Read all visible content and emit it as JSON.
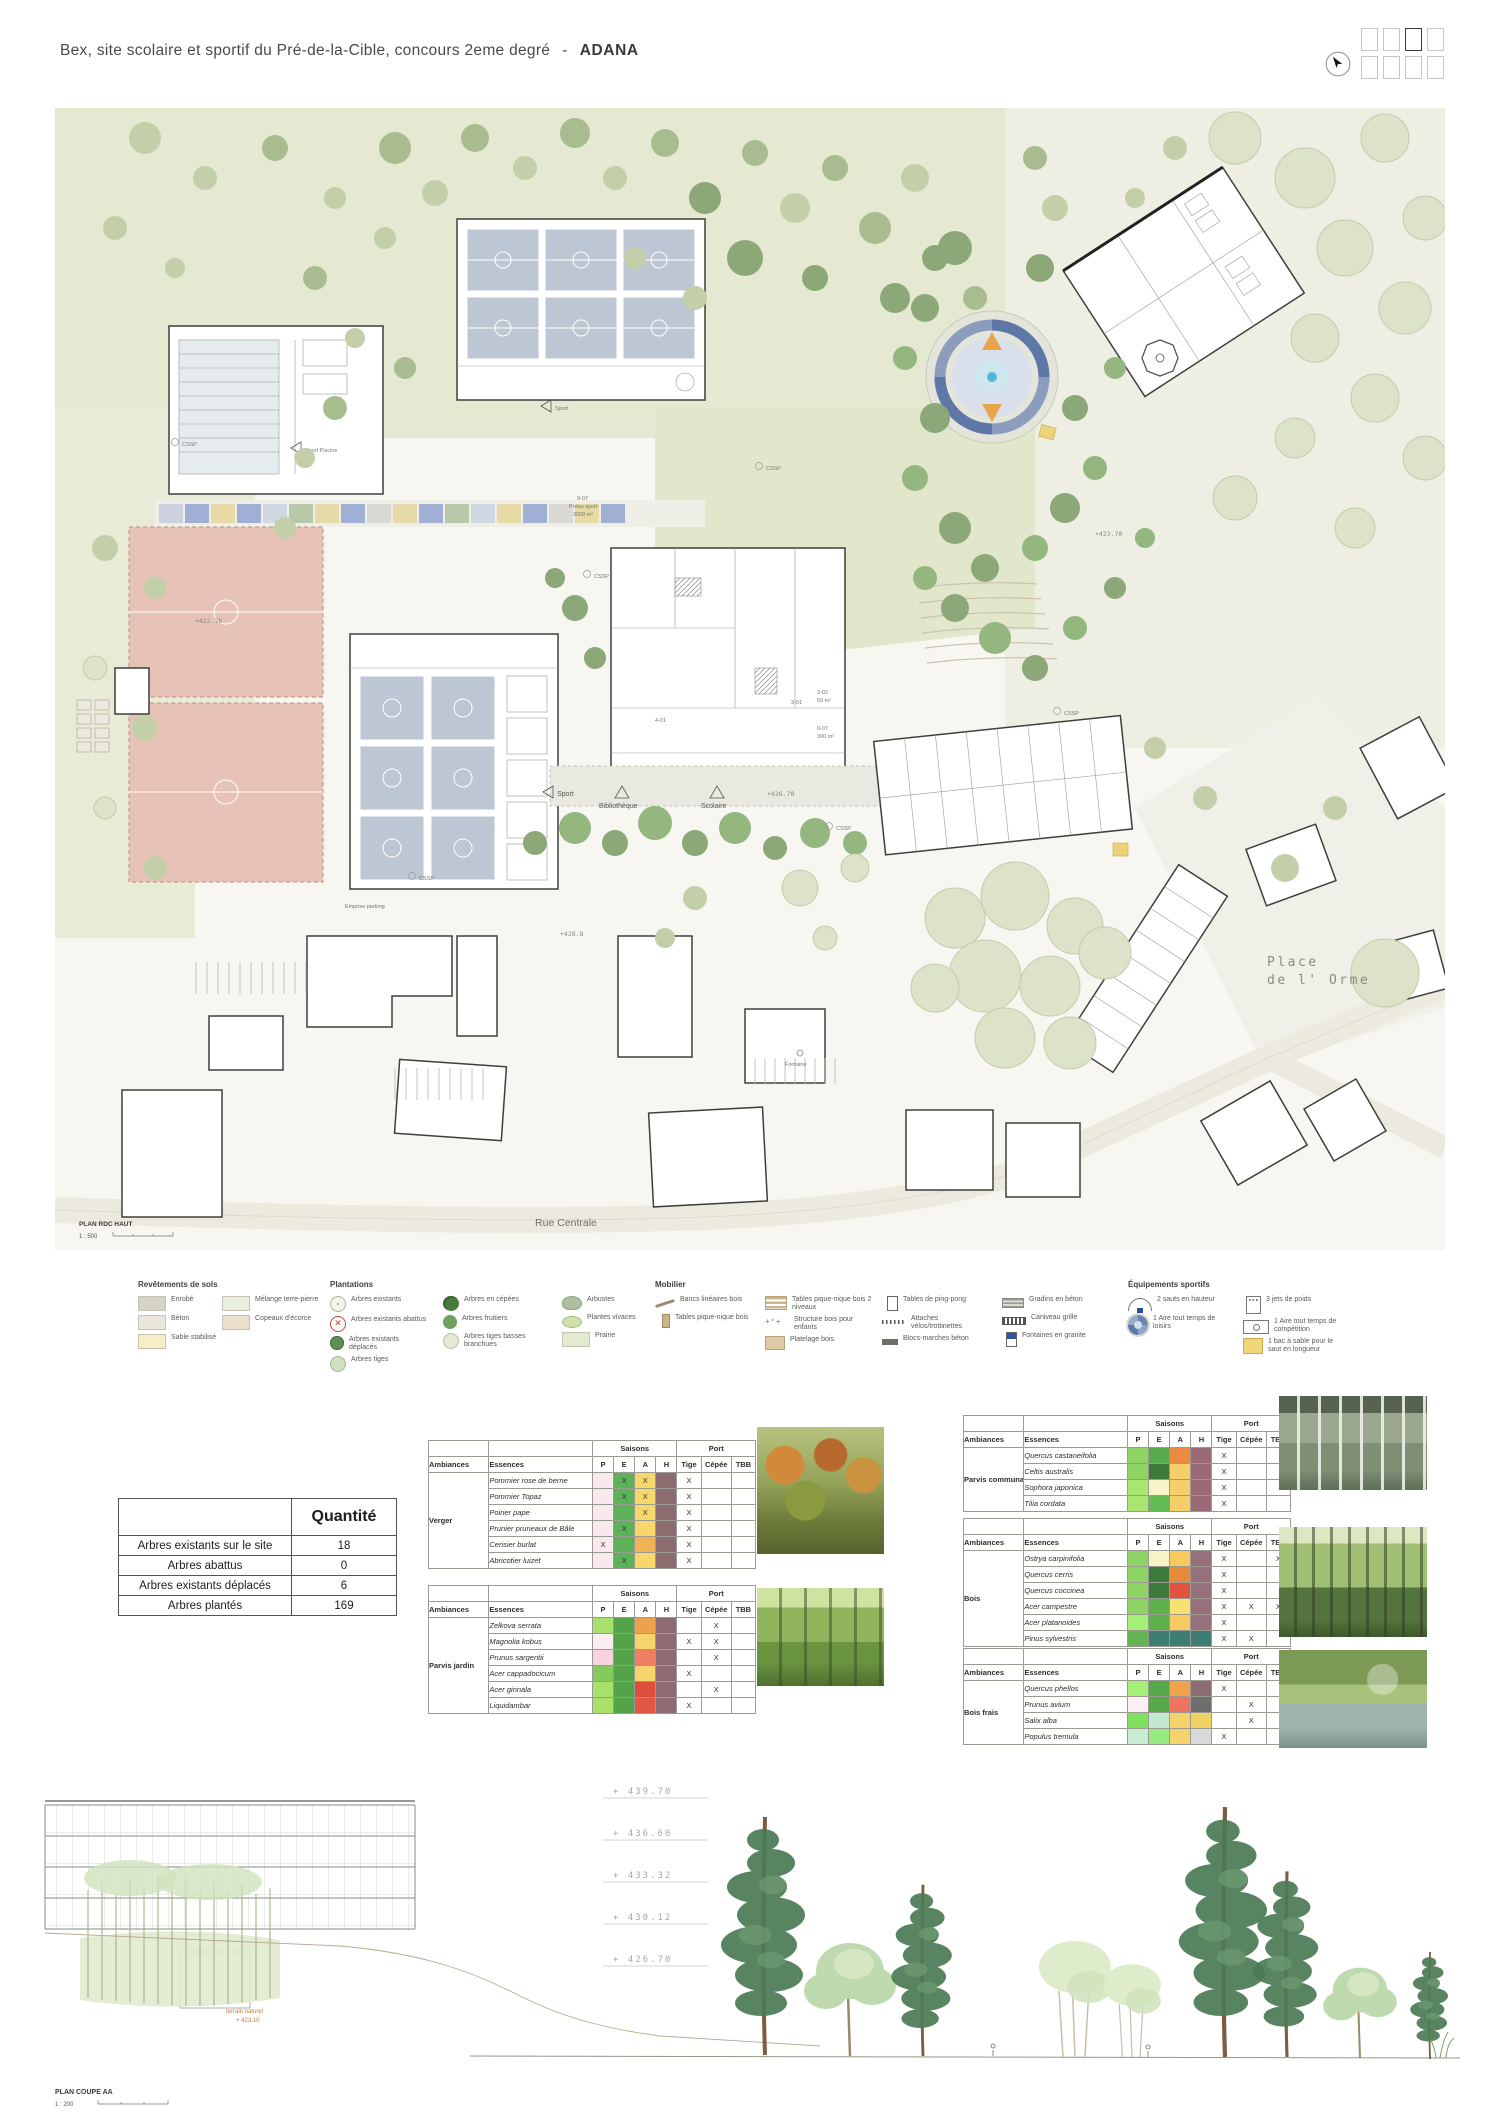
{
  "header": {
    "title": "Bex, site scolaire et sportif du Pré-de-la-Cible, concours 2eme degré",
    "separator": "-",
    "team": "ADANA"
  },
  "pager": {
    "count": 8,
    "active_index": 2
  },
  "plan": {
    "caption": {
      "title": "PLAN RDC HAUT",
      "scale": "1 : 500"
    },
    "labels": {
      "rue_centrale": "Rue Centrale",
      "place_line1": "Place",
      "place_line2": "de l' Orme",
      "sport": "Sport",
      "sport_piscine": "Sport Piscine",
      "bibliotheque": "Bibliothèque",
      "scolaire": "Scolaire",
      "preau_code": "9-07",
      "preau_name": "Préau sport",
      "preau_area": "3000 m²",
      "room1_code": "2-02",
      "room1_area": "50 m²",
      "room2_code": "0-07",
      "room2_area": "300 m²",
      "room3_code": "4-01",
      "room4_code": "3-01",
      "level_42370": "+423.70",
      "level_42276": "+422.76",
      "level_42670": "+426.70",
      "level_4288": "+428.8",
      "emprise_parking": "Emprise parking",
      "fontaine": "Fontaine",
      "cssp": "CSSP"
    }
  },
  "legend": {
    "columns": [
      {
        "header": "Revêtements de sols",
        "items": [
          {
            "icon": "swatch",
            "color": "#d8d3c7",
            "label": "Enrobé"
          },
          {
            "icon": "swatch",
            "color": "#ece5da",
            "label": "Béton"
          },
          {
            "icon": "swatch",
            "color": "#f6eec5",
            "label": "Sable stabilisé"
          }
        ]
      },
      {
        "header": "",
        "items": [
          {
            "icon": "swatch",
            "color": "#e9efdf",
            "label": "Mélange terre-pierre"
          },
          {
            "icon": "swatch",
            "color": "#eadfcb",
            "label": "Copeaux d'écorce"
          }
        ]
      },
      {
        "header": "Plantations",
        "items": [
          {
            "icon": "tree-existant",
            "label": "Arbres existants"
          },
          {
            "icon": "tree-abattu",
            "label": "Arbres existants abattus"
          },
          {
            "icon": "tree-deplace",
            "label": "Arbres existants déplacés"
          },
          {
            "icon": "tree-tige",
            "label": "Arbres tiges"
          }
        ]
      },
      {
        "header": "",
        "items": [
          {
            "icon": "tree-cepee",
            "label": "Arbres en cépées"
          },
          {
            "icon": "tree-fruitier",
            "label": "Arbres fruitiers"
          },
          {
            "icon": "tree-tbb",
            "label": "Arbres tiges basses branchues"
          }
        ]
      },
      {
        "header": "",
        "items": [
          {
            "icon": "arbuste",
            "label": "Arbustes"
          },
          {
            "icon": "vivace",
            "label": "Plantes vivaces"
          },
          {
            "icon": "swatch",
            "color": "#e2ead0",
            "label": "Prairie"
          }
        ]
      },
      {
        "header": "Mobilier",
        "items": [
          {
            "icon": "banc",
            "label": "Bancs linéaires bois"
          },
          {
            "icon": "table-pn",
            "label": "Tables pique-nique bois"
          }
        ]
      },
      {
        "header": "",
        "items": [
          {
            "icon": "table-pn2",
            "label": "Tables pique-nique bois 2 niveaux"
          },
          {
            "icon": "structure",
            "label": "Structure bois pour enfants"
          },
          {
            "icon": "platelage",
            "label": "Platelage bois"
          }
        ]
      },
      {
        "header": "",
        "items": [
          {
            "icon": "pingpong",
            "label": "Tables de ping-pong"
          },
          {
            "icon": "velos",
            "label": "Attaches vélos/trottinettes"
          },
          {
            "icon": "blocs",
            "label": "Blocs-marches béton"
          }
        ]
      },
      {
        "header": "",
        "items": [
          {
            "icon": "gradins",
            "label": "Gradins en béton"
          },
          {
            "icon": "caniveau",
            "label": "Caniveau grille"
          },
          {
            "icon": "fontaine",
            "label": "Fontaines en granite"
          }
        ]
      },
      {
        "header": "Équipements sportifs",
        "items": [
          {
            "icon": "saut-hauteur",
            "label": "2 sauts en hauteur"
          },
          {
            "icon": "aire-ronde",
            "label": "1 Aire tout temps de loisirs"
          }
        ]
      },
      {
        "header": "",
        "items": [
          {
            "icon": "jet-poids",
            "label": "3 jets de poids"
          },
          {
            "icon": "aire-comp",
            "label": "1 Aire tout temps de compétition"
          },
          {
            "icon": "sable",
            "label": "1 bac à sable pour le saut en longueur"
          }
        ]
      }
    ]
  },
  "quantity_table": {
    "header": "Quantité",
    "rows": [
      {
        "label": "Arbres existants sur le site",
        "value": "18"
      },
      {
        "label": "Arbres abattus",
        "value": "0"
      },
      {
        "label": "Arbres existants déplacés",
        "value": "6"
      },
      {
        "label": "Arbres plantés",
        "value": "169"
      }
    ]
  },
  "species_header": {
    "ambiances": "Ambiances",
    "essences": "Essences",
    "saisons": "Saisons",
    "port": "Port",
    "seasons": [
      "P",
      "E",
      "A",
      "H"
    ],
    "ports": [
      "Tige",
      "Cépée",
      "TBB"
    ]
  },
  "species_tables": [
    {
      "ambiance": "Verger",
      "rows": [
        {
          "essence": "Pommier rose de berne",
          "seasons": [
            {
              "c": "#f9e9ee"
            },
            {
              "c": "#5cb159",
              "t": "X"
            },
            {
              "c": "#f7d66b",
              "t": "X"
            },
            {
              "c": "#8d6b72"
            }
          ],
          "port": [
            "X",
            "",
            ""
          ]
        },
        {
          "essence": "Pommier Topaz",
          "seasons": [
            {
              "c": "#f9e9ee"
            },
            {
              "c": "#5cb159",
              "t": "X"
            },
            {
              "c": "#f7d66b",
              "t": "X"
            },
            {
              "c": "#8d6b72"
            }
          ],
          "port": [
            "X",
            "",
            ""
          ]
        },
        {
          "essence": "Poirier pape",
          "seasons": [
            {
              "c": "#f9e9ee"
            },
            {
              "c": "#5cb159"
            },
            {
              "c": "#f7d66b",
              "t": "X"
            },
            {
              "c": "#8d6b72"
            }
          ],
          "port": [
            "X",
            "",
            ""
          ]
        },
        {
          "essence": "Prunier pruneaux de Bâle",
          "seasons": [
            {
              "c": "#f9e9ee"
            },
            {
              "c": "#5cb159",
              "t": "X"
            },
            {
              "c": "#f7d66b"
            },
            {
              "c": "#8d6b72"
            }
          ],
          "port": [
            "X",
            "",
            ""
          ]
        },
        {
          "essence": "Cerisier burlat",
          "seasons": [
            {
              "c": "#f9e9ee",
              "t": "X"
            },
            {
              "c": "#5cb159"
            },
            {
              "c": "#f0b356"
            },
            {
              "c": "#8d6b72"
            }
          ],
          "port": [
            "X",
            "",
            ""
          ]
        },
        {
          "essence": "Abricotier luizet",
          "seasons": [
            {
              "c": "#f9e9ee"
            },
            {
              "c": "#5cb159",
              "t": "X"
            },
            {
              "c": "#f7d66b"
            },
            {
              "c": "#8d6b72"
            }
          ],
          "port": [
            "X",
            "",
            ""
          ]
        }
      ]
    },
    {
      "ambiance": "Parvis jardin",
      "rows": [
        {
          "essence": "Zelkova serrata",
          "seasons": [
            {
              "c": "#a8e06c"
            },
            {
              "c": "#55a348"
            },
            {
              "c": "#eca24d"
            },
            {
              "c": "#8d6b72"
            }
          ],
          "port": [
            "",
            "X",
            ""
          ]
        },
        {
          "essence": "Magnolia kobus",
          "seasons": [
            {
              "c": "#fbeef3"
            },
            {
              "c": "#55a348"
            },
            {
              "c": "#f6d469"
            },
            {
              "c": "#8d6b72"
            }
          ],
          "port": [
            "X",
            "X",
            ""
          ]
        },
        {
          "essence": "Prunus sargentii",
          "seasons": [
            {
              "c": "#f9d2e2"
            },
            {
              "c": "#55a348"
            },
            {
              "c": "#ee7f63"
            },
            {
              "c": "#8d6b72"
            }
          ],
          "port": [
            "",
            "X",
            ""
          ]
        },
        {
          "essence": "Acer cappadocicum",
          "seasons": [
            {
              "c": "#83cb5f"
            },
            {
              "c": "#55a348"
            },
            {
              "c": "#f6d469"
            },
            {
              "c": "#8d6b72"
            }
          ],
          "port": [
            "X",
            "",
            ""
          ]
        },
        {
          "essence": "Acer ginnala",
          "seasons": [
            {
              "c": "#a8e06c"
            },
            {
              "c": "#55a348"
            },
            {
              "c": "#dd4f3a"
            },
            {
              "c": "#8d6b72"
            }
          ],
          "port": [
            "",
            "X",
            ""
          ]
        },
        {
          "essence": "Liquidambar",
          "seasons": [
            {
              "c": "#a8e06c"
            },
            {
              "c": "#55a348"
            },
            {
              "c": "#e25744"
            },
            {
              "c": "#8d6b72"
            }
          ],
          "port": [
            "X",
            "",
            ""
          ]
        }
      ]
    },
    {
      "ambiance": "Parvis communal",
      "rows": [
        {
          "essence": "Quercus castaneifolia",
          "seasons": [
            {
              "c": "#8ed464"
            },
            {
              "c": "#58ab4c"
            },
            {
              "c": "#ec8b3f"
            },
            {
              "c": "#9a6b77"
            }
          ],
          "port": [
            "X",
            "",
            ""
          ]
        },
        {
          "essence": "Celtis australis",
          "seasons": [
            {
              "c": "#8ed464"
            },
            {
              "c": "#3f7a3d"
            },
            {
              "c": "#f6cf6b"
            },
            {
              "c": "#9a6b77"
            }
          ],
          "port": [
            "X",
            "",
            ""
          ]
        },
        {
          "essence": "Sophora japonica",
          "seasons": [
            {
              "c": "#a9e66f"
            },
            {
              "c": "#f6f3c9"
            },
            {
              "c": "#f6cf6b"
            },
            {
              "c": "#9a6b77"
            }
          ],
          "port": [
            "X",
            "",
            ""
          ]
        },
        {
          "essence": "Tilia cordata",
          "seasons": [
            {
              "c": "#a9e66f"
            },
            {
              "c": "#63bb54"
            },
            {
              "c": "#f6cf6b"
            },
            {
              "c": "#9a6b77"
            }
          ],
          "port": [
            "X",
            "",
            ""
          ]
        }
      ]
    },
    {
      "ambiance": "Bois",
      "rows": [
        {
          "essence": "Ostrya carpinifolia",
          "seasons": [
            {
              "c": "#8ed464"
            },
            {
              "c": "#f8f4c6"
            },
            {
              "c": "#f7c95e"
            },
            {
              "c": "#96707a"
            }
          ],
          "port": [
            "X",
            "",
            "X"
          ]
        },
        {
          "essence": "Quercus cerris",
          "seasons": [
            {
              "c": "#8ed464"
            },
            {
              "c": "#3f7a3d"
            },
            {
              "c": "#e88a3c"
            },
            {
              "c": "#96707a"
            }
          ],
          "port": [
            "X",
            "",
            ""
          ]
        },
        {
          "essence": "Quercus coccinea",
          "seasons": [
            {
              "c": "#8ed464"
            },
            {
              "c": "#3f7a3d"
            },
            {
              "c": "#e25240"
            },
            {
              "c": "#96707a"
            }
          ],
          "port": [
            "X",
            "",
            ""
          ]
        },
        {
          "essence": "Acer campestre",
          "seasons": [
            {
              "c": "#8ed464"
            },
            {
              "c": "#5cb04e"
            },
            {
              "c": "#f8e173"
            },
            {
              "c": "#96707a"
            }
          ],
          "port": [
            "X",
            "X",
            "X"
          ]
        },
        {
          "essence": "Acer platanoides",
          "seasons": [
            {
              "c": "#a4ef75"
            },
            {
              "c": "#5cb04e"
            },
            {
              "c": "#f7c95e"
            },
            {
              "c": "#96707a"
            }
          ],
          "port": [
            "X",
            "",
            ""
          ]
        },
        {
          "essence": "Pinus sylvestris",
          "seasons": [
            {
              "c": "#63b554"
            },
            {
              "c": "#3e7d74"
            },
            {
              "c": "#3e7d74"
            },
            {
              "c": "#3e7d74"
            }
          ],
          "port": [
            "X",
            "X",
            ""
          ]
        }
      ]
    },
    {
      "ambiance": "Bois frais",
      "rows": [
        {
          "essence": "Quercus phellos",
          "seasons": [
            {
              "c": "#a4ef75"
            },
            {
              "c": "#56a94a"
            },
            {
              "c": "#f0a24c"
            },
            {
              "c": "#8d6b72"
            }
          ],
          "port": [
            "X",
            "",
            ""
          ]
        },
        {
          "essence": "Prunus avium",
          "seasons": [
            {
              "c": "#fdf0f4"
            },
            {
              "c": "#56a94a"
            },
            {
              "c": "#ee7360"
            },
            {
              "c": "#6e6e6e"
            }
          ],
          "port": [
            "",
            "X",
            ""
          ]
        },
        {
          "essence": "Salix alba",
          "seasons": [
            {
              "c": "#7de05f"
            },
            {
              "c": "#c3ead0"
            },
            {
              "c": "#f6d36a"
            },
            {
              "c": "#f0d264"
            }
          ],
          "port": [
            "",
            "X",
            ""
          ]
        },
        {
          "essence": "Populus tremula",
          "seasons": [
            {
              "c": "#c8ecd2"
            },
            {
              "c": "#97e983"
            },
            {
              "c": "#f6d36a"
            },
            {
              "c": "#d9d9d9"
            }
          ],
          "port": [
            "X",
            "",
            ""
          ]
        }
      ]
    }
  ],
  "section": {
    "caption": {
      "title": "PLAN COUPE AA",
      "scale": "1 : 200"
    },
    "levels": [
      "+ 439.70",
      "+ 436.60",
      "+ 433.32",
      "+ 430.12",
      "+ 426.70"
    ],
    "terrain_label": "terrain naturel",
    "terrain_level": "+ 423.10"
  }
}
